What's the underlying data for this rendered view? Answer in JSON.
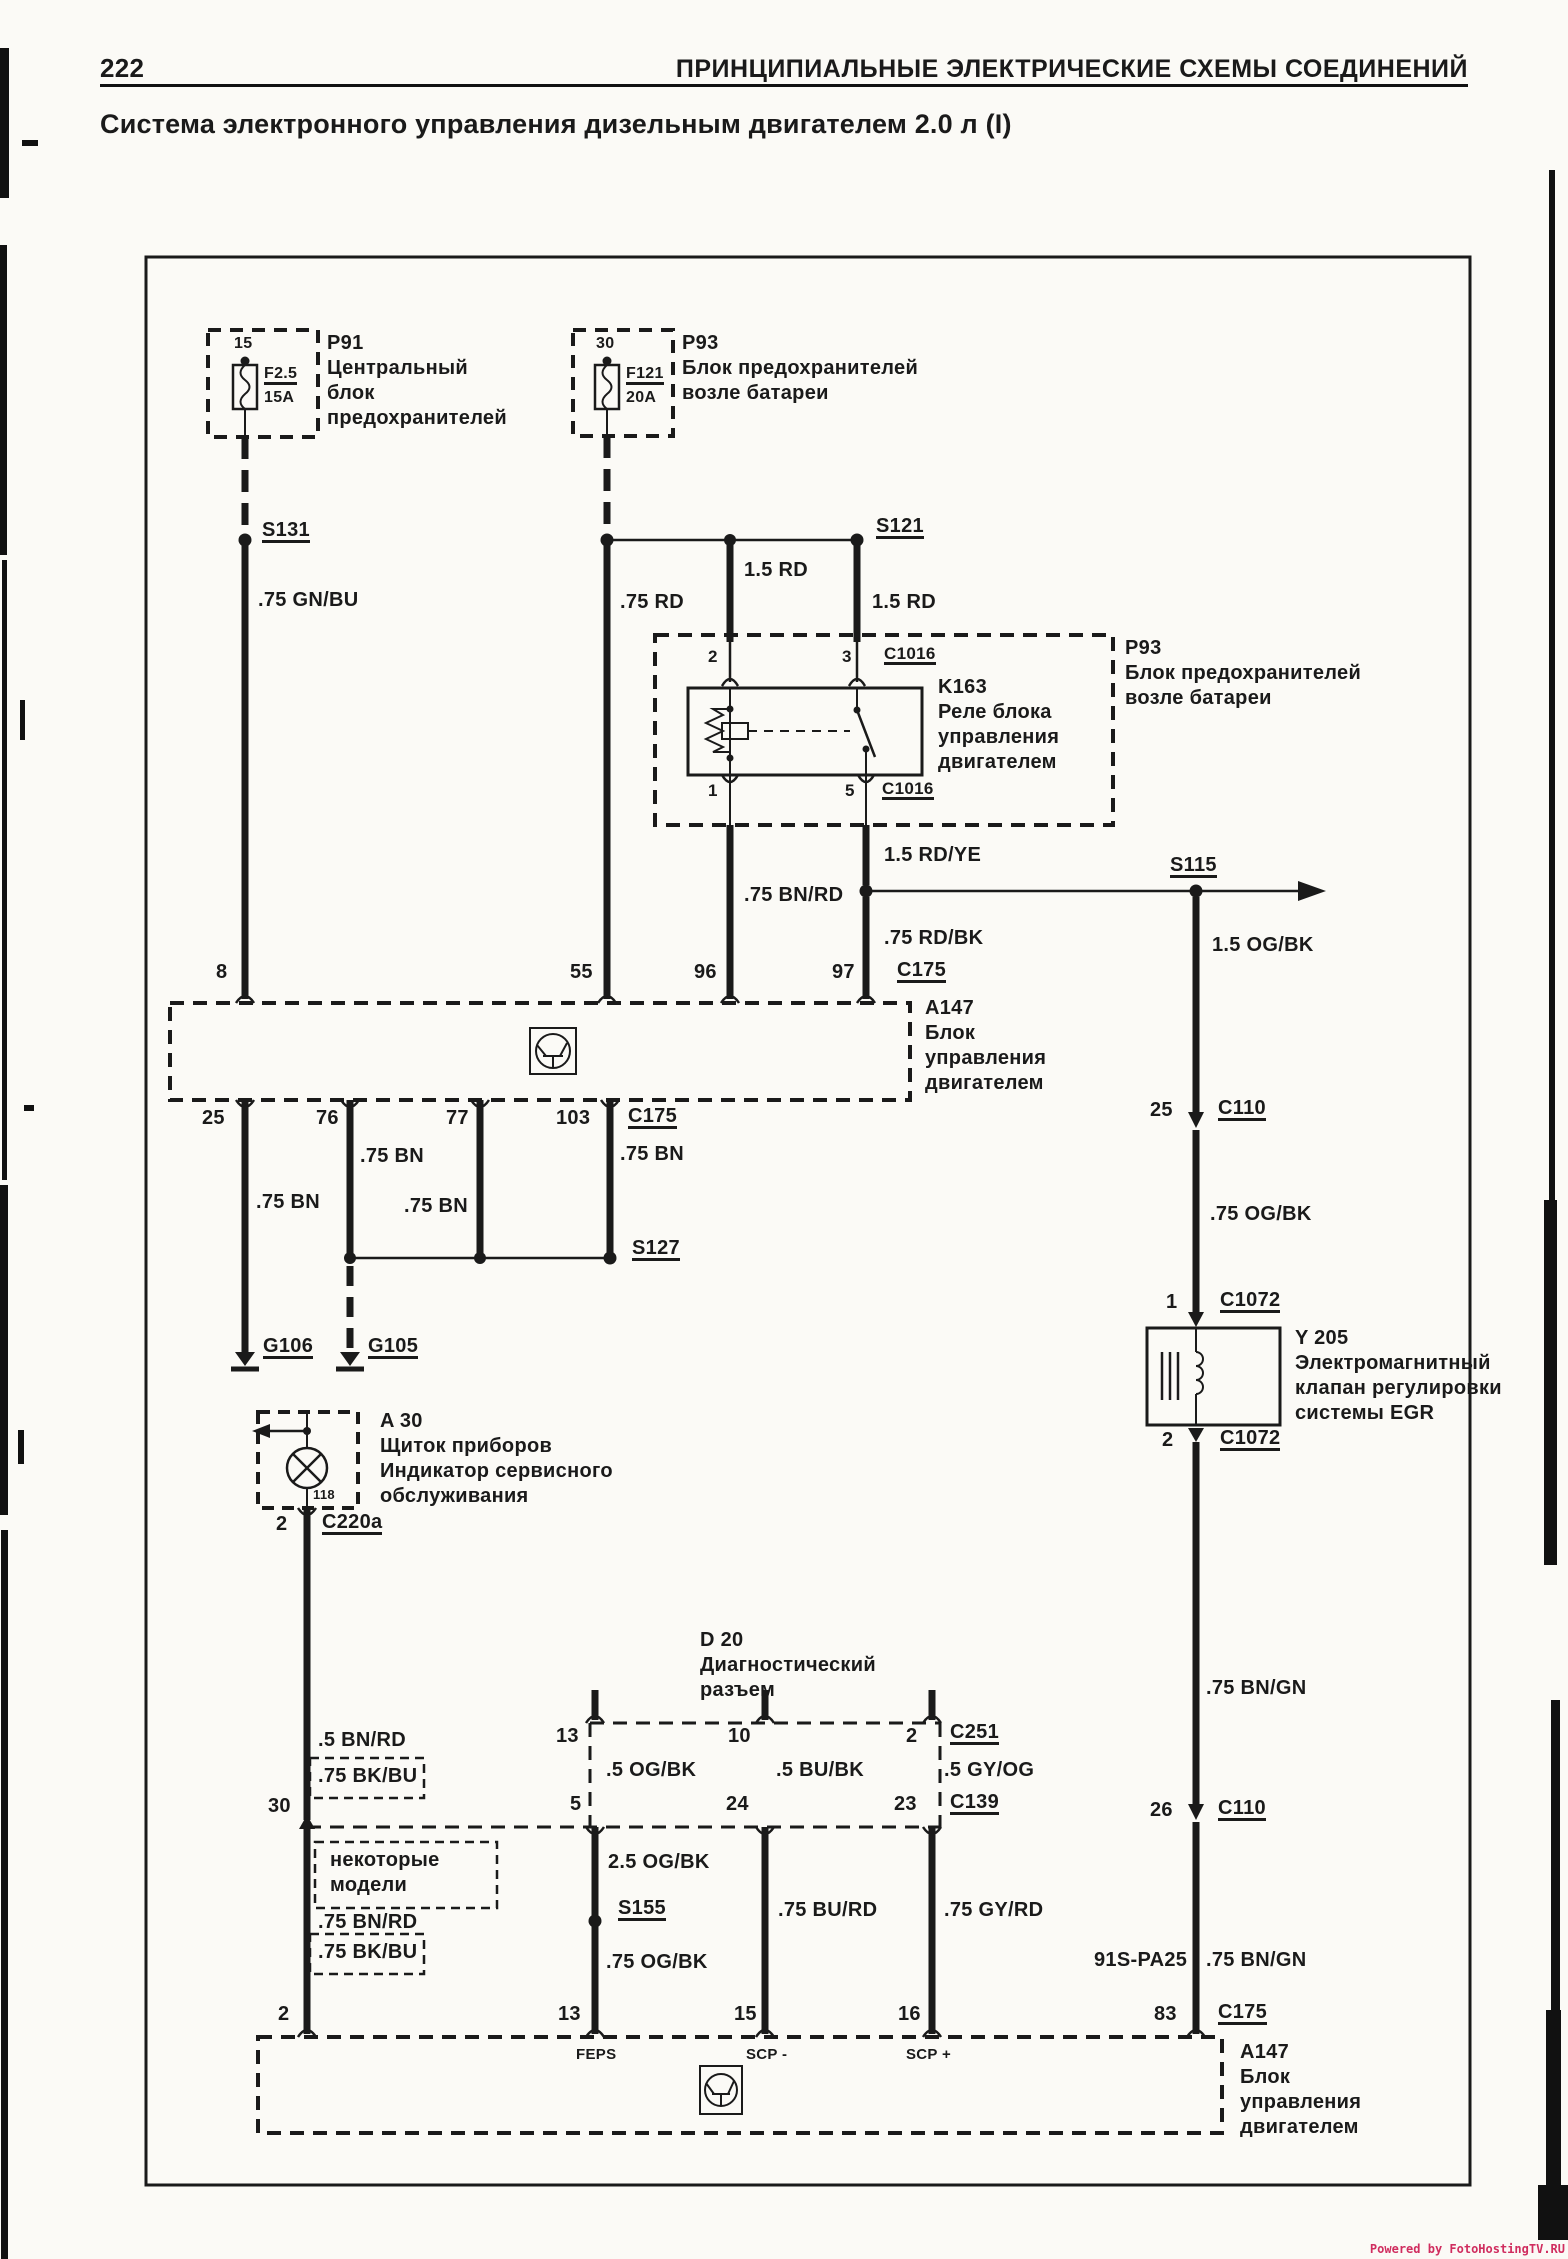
{
  "page": {
    "number": "222",
    "header": "ПРИНЦИПИАЛЬНЫЕ ЭЛЕКТРИЧЕСКИЕ СХЕМЫ СОЕДИНЕНИЙ",
    "title": "Система электронного управления дизельным двигателем 2.0 л (I)",
    "watermark": "Powered by FotoHostingTV.RU"
  },
  "fuse_p91": {
    "pin": "15",
    "name": "F2.5",
    "rating": "15A",
    "label": [
      "P91",
      "Центральный",
      "блок",
      "предохранителей"
    ]
  },
  "fuse_p93": {
    "pin": "30",
    "name": "F121",
    "rating": "20A",
    "label": [
      "P93",
      "Блок предохранителей",
      "возле батареи"
    ]
  },
  "relay_k163": {
    "label": [
      "K163",
      "Реле блока",
      "управления",
      "двигателем"
    ],
    "box_label": [
      "P93",
      "Блок предохранителей",
      "возле батареи"
    ],
    "pin_top_left": "2",
    "pin_top_right": "3",
    "pin_bottom_left": "1",
    "pin_bottom_right": "5",
    "conn_top": "C1016",
    "conn_bottom": "C1016"
  },
  "ecu_top": {
    "label": [
      "A147",
      "Блок",
      "управления",
      "двигателем"
    ],
    "pin8": "8",
    "pin55": "55",
    "pin96": "96",
    "pin97": "97",
    "conn_top": "C175",
    "pin25": "25",
    "pin76": "76",
    "pin77": "77",
    "pin103": "103",
    "conn_bottom": "C175"
  },
  "cluster_a30": {
    "label": [
      "A 30",
      "Щиток приборов",
      "Индикатор сервисного",
      "обслуживания"
    ],
    "pin_inner": "118",
    "pin": "2",
    "conn": "C220a"
  },
  "diag_d20": {
    "label": [
      "D 20",
      "Диагностический",
      "разъем"
    ],
    "pin13": "13",
    "pin10": "10",
    "pin2": "2",
    "conn_top": "C251",
    "pin5": "5",
    "pin24": "24",
    "pin23": "23",
    "conn_bottom": "C139",
    "pin13b": "13",
    "pin15b": "15",
    "pin16b": "16"
  },
  "valve_y205": {
    "label": [
      "Y 205",
      "Электромагнитный",
      "клапан регулировки",
      "системы EGR"
    ],
    "pin1": "1",
    "conn1": "C1072",
    "pin2": "2",
    "conn2": "C1072"
  },
  "ecu_bottom": {
    "label": [
      "A147",
      "Блок",
      "управления",
      "двигателем"
    ],
    "pin2": "2",
    "sig_feps": "FEPS",
    "sig_scp_minus": "SCP -",
    "sig_scp_plus": "SCP +",
    "conn": "C175"
  },
  "right_branch": {
    "pin25": "25",
    "conn25": "C110",
    "pin26": "26",
    "conn26": "C110",
    "pin83": "83",
    "conn83": "C175",
    "harness": "91S-PA25"
  },
  "left_branch": {
    "pin30": "30",
    "pin2": "2"
  },
  "junctions": {
    "s131": "S131",
    "s121": "S121",
    "s115": "S115",
    "s127": "S127",
    "s155": "S155"
  },
  "grounds": {
    "g106": "G106",
    "g105": "G105"
  },
  "note_some_models": [
    "некоторые",
    "модели"
  ],
  "wires": {
    "gn_bu": ".75 GN/BU",
    "rd75": ".75 RD",
    "rd15_mid": "1.5 RD",
    "rd15_right": "1.5 RD",
    "rdye15": "1.5 RD/YE",
    "bnrd75": ".75 BN/RD",
    "rdbk75": ".75 RD/BK",
    "ogbk15": "1.5 OG/BK",
    "ogbk75_right": ".75 OG/BK",
    "bn75_a": ".75 BN",
    "bn75_b": ".75 BN",
    "bn75_c": ".75 BN",
    "bn75_d": ".75 BN",
    "bngn75_a": ".75 BN/GN",
    "bngn75_b": ".75 BN/GN",
    "bnrd5": ".5 BN/RD",
    "bkbu75_a": ".75 BK/BU",
    "bnrd75_b": ".75 BN/RD",
    "bkbu75_b": ".75 BK/BU",
    "ogbk5": ".5 OG/BK",
    "bubk5": ".5 BU/BK",
    "gyog5": ".5 GY/OG",
    "ogbk25": "2.5 OG/BK",
    "ogbk75_mid": ".75 OG/BK",
    "burd75": ".75 BU/RD",
    "gyrd75": ".75 GY/RD"
  }
}
